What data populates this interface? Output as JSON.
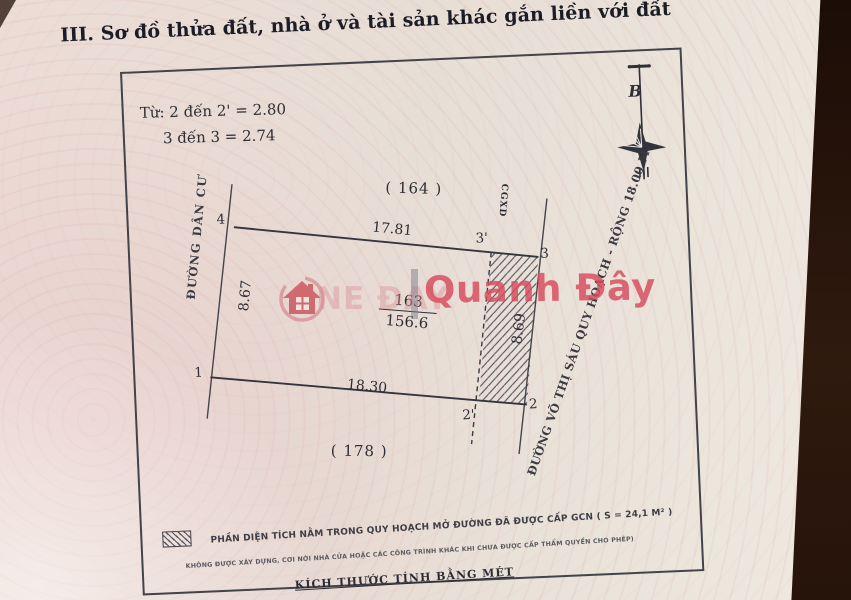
{
  "header": {
    "section_title": "III. Sơ đồ thửa đất, nhà ở và tài sản khác gắn liền với đất"
  },
  "notes": {
    "line1": "Từ: 2 đến 2' = 2.80",
    "line2": "3 đến 3 = 2.74"
  },
  "compass": {
    "north_label": "B"
  },
  "parcel": {
    "number": "163",
    "area": "156.6",
    "adjacent_top": "( 164 )",
    "adjacent_bottom": "( 178 )",
    "dim_top": "17.81",
    "dim_bottom": "18.30",
    "dim_left": "8.67",
    "dim_right": "8.69",
    "boundary_marker": "CGXD",
    "corners": {
      "c1": "1",
      "c2": "2",
      "c2p": "2'",
      "c3": "3",
      "c3p": "3'",
      "c4": "4"
    },
    "road_left": "ĐƯỜNG DÂN CƯ",
    "road_right": "ĐƯỜNG VÕ THỊ SÁU QUY HOẠCH - RỘNG 18.00 M"
  },
  "legend": {
    "line1": "PHẦN DIỆN TÍCH NẰM TRONG QUY HOẠCH MỞ ĐƯỜNG ĐÃ ĐƯỢC CẤP GCN ( S = 24,1 M² )",
    "line2": "KHÔNG ĐƯỢC XÂY DỰNG, CƠI NỚI NHÀ CỬA HOẶC CÁC CÔNG TRÌNH KHÁC KHI CHƯA ĐƯỢC CẤP THẨM QUYỀN CHO PHÉP)",
    "scale_note": "KÍCH THƯỚC TÍNH BẰNG MÉT"
  },
  "watermark": {
    "brand_left": "NE ĐAY",
    "brand_right": "Quanh Đây"
  },
  "colors": {
    "paper": "#e8ded7",
    "ink": "#2e2e36",
    "watermark_red": "#d8495c",
    "photo_dark_edge": "#2f1a0e"
  }
}
